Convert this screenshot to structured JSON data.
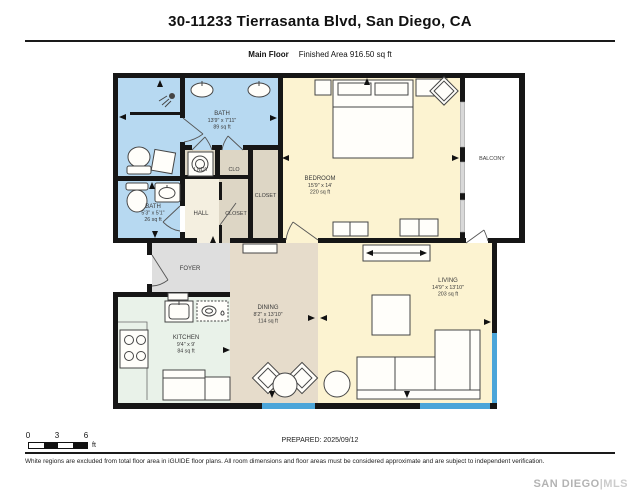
{
  "header": {
    "title": "30-11233 Tierrasanta Blvd, San Diego, CA",
    "floor_label": "Main Floor",
    "area_label": "Finished Area 916.50 sq ft"
  },
  "rooms": {
    "bath_main": {
      "name": "BATH",
      "dims": "13'9\" x 7'11\"",
      "area": "89 sq ft"
    },
    "bath_small": {
      "name": "BATH",
      "dims": "5'3\" x 5'1\"",
      "area": "26 sq ft"
    },
    "lndy": {
      "name": "LNDY"
    },
    "clo": {
      "name": "CLO"
    },
    "closet_a": {
      "name": "CLOSET"
    },
    "closet_b": {
      "name": "CLOSET"
    },
    "hall": {
      "name": "HALL"
    },
    "bedroom": {
      "name": "BEDROOM",
      "dims": "15'9\" x 14'",
      "area": "220 sq ft"
    },
    "balcony": {
      "name": "BALCONY"
    },
    "foyer": {
      "name": "FOYER"
    },
    "kitchen": {
      "name": "KITCHEN",
      "dims": "9'4\" x 9'",
      "area": "84 sq ft"
    },
    "dining": {
      "name": "DINING",
      "dims": "8'2\" x 13'10\"",
      "area": "114 sq ft"
    },
    "living": {
      "name": "LIVING",
      "dims": "14'9\" x 13'10\"",
      "area": "203 sq ft"
    }
  },
  "scale_bar": {
    "ticks": [
      "0",
      "3",
      "6"
    ],
    "unit": "ft"
  },
  "footer": {
    "prepared": "PREPARED: 2025/09/12",
    "disclaimer": "White regions are excluded from total floor area in iGUIDE floor plans. All room dimensions and floor areas must be considered approximate and are subject to independent verification.",
    "brand_primary": "SAN DIEGO",
    "brand_secondary": "|MLS"
  },
  "colors": {
    "wall": "#161616",
    "bath": "#b7d9f1",
    "bedroom_living": "#fcf3d1",
    "dining": "#e6dccb",
    "kitchen": "#e9f2e9",
    "foyer": "#dedede",
    "hall": "#f4efe0",
    "closet": "#ddd6c5",
    "balcony": "#ffffff",
    "window": "#4ba5d9"
  },
  "icons": [
    "shower-icon",
    "toilet-icon",
    "sink-icon",
    "washer-icon",
    "stove-icon",
    "dishwasher-icon",
    "microwave-icon",
    "bed-icon",
    "sofa-icon",
    "tv-console-icon",
    "coffee-table-icon",
    "side-table-icon",
    "dining-table-icon",
    "dining-chair-icon",
    "bench-icon",
    "accent-chair-icon",
    "hamper-icon",
    "door-direction-arrow"
  ]
}
